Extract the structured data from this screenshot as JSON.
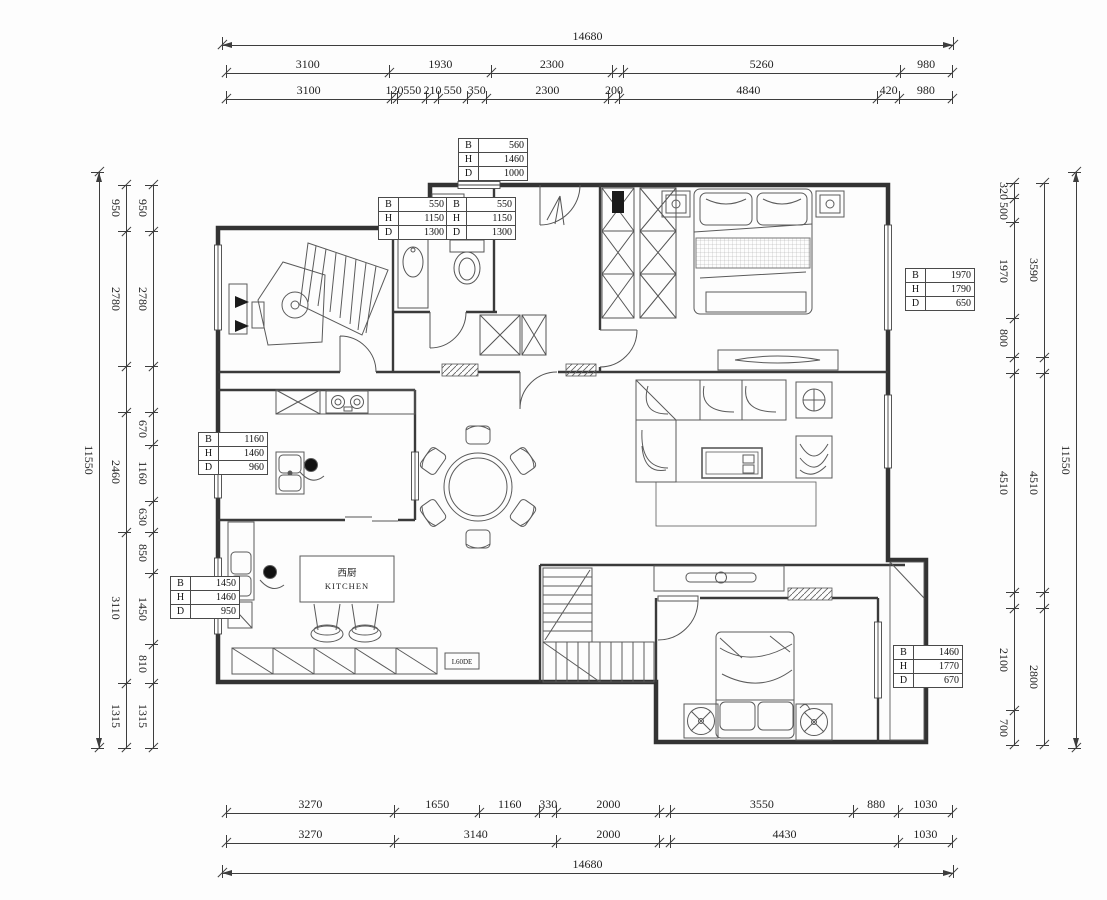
{
  "palette": {
    "dim_line": "#3d3d3d",
    "wall": "#333333",
    "furniture": "#5a5a5a"
  },
  "labels": {
    "kitchen_cn": "西厨",
    "kitchen_en": "KITCHEN",
    "cabinet_code": "L60DE"
  },
  "schedules": [
    {
      "x": 458,
      "y": 138,
      "rows": [
        [
          "B",
          "560"
        ],
        [
          "H",
          "1460"
        ],
        [
          "D",
          "1000"
        ]
      ]
    },
    {
      "x": 378,
      "y": 197,
      "rows": [
        [
          "B",
          "550"
        ],
        [
          "H",
          "1150"
        ],
        [
          "D",
          "1300"
        ]
      ]
    },
    {
      "x": 446,
      "y": 197,
      "rows": [
        [
          "B",
          "550"
        ],
        [
          "H",
          "1150"
        ],
        [
          "D",
          "1300"
        ]
      ]
    },
    {
      "x": 905,
      "y": 268,
      "rows": [
        [
          "B",
          "1970"
        ],
        [
          "H",
          "1790"
        ],
        [
          "D",
          "650"
        ]
      ]
    },
    {
      "x": 198,
      "y": 432,
      "rows": [
        [
          "B",
          "1160"
        ],
        [
          "H",
          "1460"
        ],
        [
          "D",
          "960"
        ]
      ]
    },
    {
      "x": 170,
      "y": 576,
      "rows": [
        [
          "B",
          "1450"
        ],
        [
          "H",
          "1460"
        ],
        [
          "D",
          "950"
        ]
      ]
    },
    {
      "x": 893,
      "y": 645,
      "rows": [
        [
          "B",
          "1460"
        ],
        [
          "H",
          "1770"
        ],
        [
          "D",
          "670"
        ]
      ]
    }
  ],
  "chains": [
    {
      "name": "top-total",
      "dir": "h",
      "a": 222,
      "b": 953,
      "pos": 45,
      "total": true,
      "segs": [
        {
          "v": 14680,
          "t": "14680"
        }
      ]
    },
    {
      "name": "top-mid",
      "dir": "h",
      "a": 226,
      "b": 952,
      "pos": 73,
      "segs": [
        {
          "v": 3100,
          "t": "3100"
        },
        {
          "v": 1930,
          "t": "1930"
        },
        {
          "v": 2300,
          "t": "2300"
        },
        {
          "v": 200,
          "t": ""
        },
        {
          "v": 5260,
          "t": "5260"
        },
        {
          "v": 980,
          "t": "980"
        }
      ]
    },
    {
      "name": "top-inner",
      "dir": "h",
      "a": 226,
      "b": 952,
      "pos": 99,
      "segs": [
        {
          "v": 3100,
          "t": "3100"
        },
        {
          "v": 120,
          "t": "120"
        },
        {
          "v": 550,
          "t": "550"
        },
        {
          "v": 210,
          "t": "210"
        },
        {
          "v": 550,
          "t": "550"
        },
        {
          "v": 350,
          "t": "350"
        },
        {
          "v": 2300,
          "t": "2300"
        },
        {
          "v": 200,
          "t": "200"
        },
        {
          "v": 4840,
          "t": "4840"
        },
        {
          "v": 420,
          "t": "420"
        },
        {
          "v": 980,
          "t": "980"
        }
      ]
    },
    {
      "name": "bottom-inner",
      "dir": "h",
      "a": 226,
      "b": 952,
      "pos": 813,
      "segs": [
        {
          "v": 3270,
          "t": "3270"
        },
        {
          "v": 1650,
          "t": "1650"
        },
        {
          "v": 1160,
          "t": "1160"
        },
        {
          "v": 330,
          "t": "330"
        },
        {
          "v": 2000,
          "t": "2000"
        },
        {
          "v": 200,
          "t": ""
        },
        {
          "v": 3550,
          "t": "3550"
        },
        {
          "v": 880,
          "t": "880"
        },
        {
          "v": 1030,
          "t": "1030"
        }
      ]
    },
    {
      "name": "bottom-mid",
      "dir": "h",
      "a": 226,
      "b": 952,
      "pos": 843,
      "segs": [
        {
          "v": 3270,
          "t": "3270"
        },
        {
          "v": 3140,
          "t": "3140"
        },
        {
          "v": 2000,
          "t": "2000"
        },
        {
          "v": 200,
          "t": ""
        },
        {
          "v": 4430,
          "t": "4430"
        },
        {
          "v": 1030,
          "t": "1030"
        }
      ]
    },
    {
      "name": "bottom-total",
      "dir": "h",
      "a": 222,
      "b": 953,
      "pos": 873,
      "total": true,
      "segs": [
        {
          "v": 14680,
          "t": "14680"
        }
      ]
    },
    {
      "name": "left-total",
      "dir": "v",
      "a": 172,
      "b": 748,
      "pos": 99,
      "total": true,
      "segs": [
        {
          "v": 11550,
          "t": "11550"
        }
      ]
    },
    {
      "name": "left-mid",
      "dir": "v",
      "a": 185,
      "b": 748,
      "pos": 126,
      "segs": [
        {
          "v": 950,
          "t": "950"
        },
        {
          "v": 2780,
          "t": "2780"
        },
        {
          "v": 935,
          "t": ""
        },
        {
          "v": 2460,
          "t": "2460"
        },
        {
          "v": 3110,
          "t": "3110"
        },
        {
          "v": 1315,
          "t": "1315"
        }
      ]
    },
    {
      "name": "left-inner",
      "dir": "v",
      "a": 185,
      "b": 748,
      "pos": 153,
      "segs": [
        {
          "v": 950,
          "t": "950"
        },
        {
          "v": 2780,
          "t": "2780"
        },
        {
          "v": 935,
          "t": ""
        },
        {
          "v": 670,
          "t": "670"
        },
        {
          "v": 1160,
          "t": "1160"
        },
        {
          "v": 630,
          "t": "630"
        },
        {
          "v": 850,
          "t": "850"
        },
        {
          "v": 1450,
          "t": "1450"
        },
        {
          "v": 810,
          "t": "810"
        },
        {
          "v": 1315,
          "t": "1315"
        }
      ]
    },
    {
      "name": "right-inner",
      "dir": "v",
      "a": 183,
      "b": 745,
      "pos": 1014,
      "segs": [
        {
          "v": 320,
          "t": "320"
        },
        {
          "v": 500,
          "t": "500"
        },
        {
          "v": 1970,
          "t": "1970"
        },
        {
          "v": 800,
          "t": "800"
        },
        {
          "v": 325,
          "t": ""
        },
        {
          "v": 4510,
          "t": "4510"
        },
        {
          "v": 325,
          "t": ""
        },
        {
          "v": 2100,
          "t": "2100"
        },
        {
          "v": 700,
          "t": "700"
        }
      ]
    },
    {
      "name": "right-mid",
      "dir": "v",
      "a": 183,
      "b": 745,
      "pos": 1044,
      "segs": [
        {
          "v": 3590,
          "t": "3590"
        },
        {
          "v": 325,
          "t": ""
        },
        {
          "v": 4510,
          "t": "4510"
        },
        {
          "v": 325,
          "t": ""
        },
        {
          "v": 2800,
          "t": "2800"
        }
      ]
    },
    {
      "name": "right-total",
      "dir": "v",
      "a": 172,
      "b": 748,
      "pos": 1076,
      "total": true,
      "segs": [
        {
          "v": 11550,
          "t": "11550"
        }
      ]
    }
  ]
}
